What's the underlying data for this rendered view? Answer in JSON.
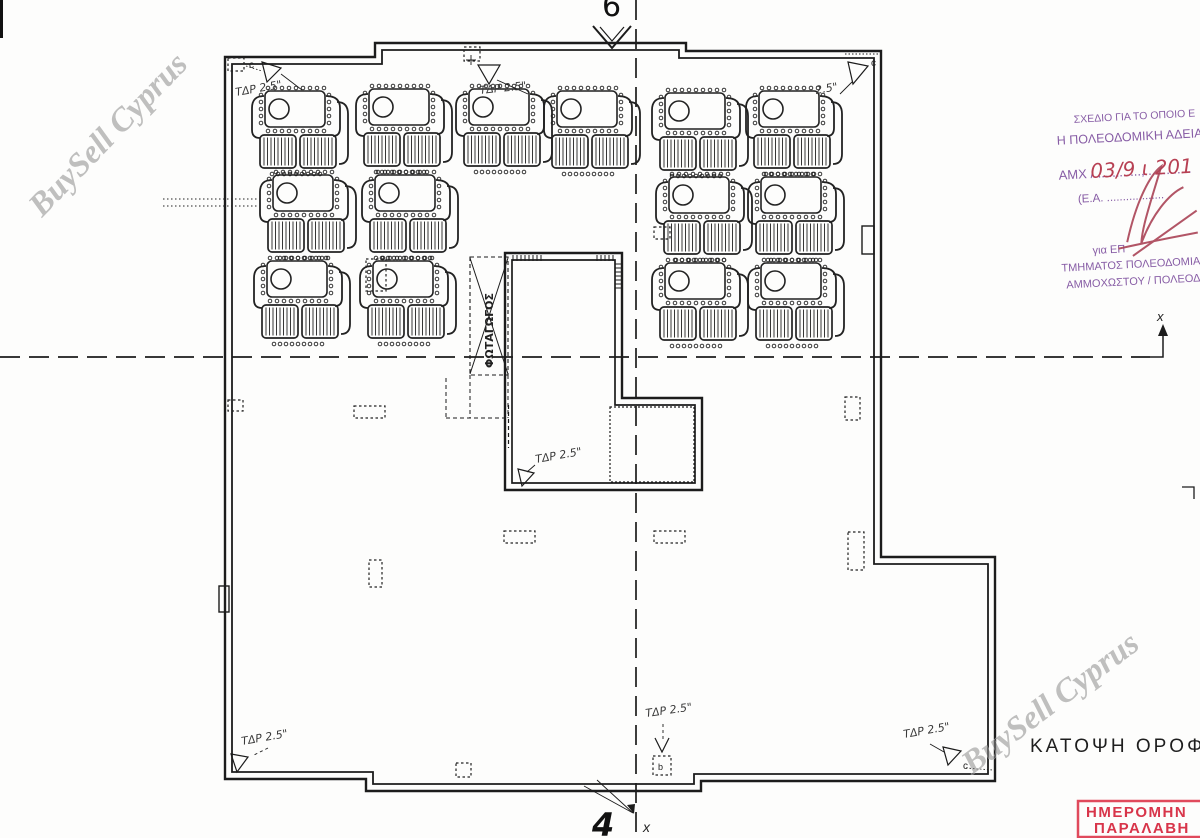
{
  "title": "ΚΑΤΟΨΗ ΟΡΟΦΗΣ",
  "watermark": {
    "text": "BuySell Cyprus",
    "color": "#8d8d8d"
  },
  "stamp_purple": {
    "color": "#7d4f9e",
    "hand_color": "#b23045",
    "lines": {
      "l0": "ΣΧΕΔΙΟ ΓΙΑ ΤΟ ΟΠΟΙΟ Ε",
      "l1": "Η ΠΟΛΕΟΔΟΜΙΚΗ ΑΔΕΙΑ",
      "l2": "ΑΜΧ /.............,.............",
      "l3": "(Ε.Α. ..................",
      "l4": "για ΕΠ",
      "l5": "ΤΜΗΜΑΤΟΣ ΠΟΛΕΟΔΟΜΙΑ",
      "l6": "ΑΜΜΟΧΩΣΤΟΥ / ΠΟΛΕΟΔ"
    },
    "date_hand": "03/9 ι 201"
  },
  "stamp_red": {
    "color": "#d8354a",
    "line1": "ΗΜΕΡΟΜΗΝ",
    "line2": "ΠΑΡΑΛΑΒΗ"
  },
  "lightwell_label": "ΦΩΤΑΓΩΓΟΣ",
  "markers": {
    "section_top": "6",
    "section_bottom": "4",
    "axis_x_right": "x",
    "axis_x_bottom": "x",
    "corner_top_left": "c",
    "corner_top_right": "c",
    "corner_bottom_right": "c",
    "vent_letter": "b",
    "cross": "+"
  },
  "plan": {
    "line_color": "#1c1c1c",
    "units": [
      {
        "x": 248,
        "y": 86
      },
      {
        "x": 352,
        "y": 84
      },
      {
        "x": 452,
        "y": 84
      },
      {
        "x": 540,
        "y": 86
      },
      {
        "x": 648,
        "y": 88
      },
      {
        "x": 742,
        "y": 86
      },
      {
        "x": 256,
        "y": 170
      },
      {
        "x": 358,
        "y": 170
      },
      {
        "x": 652,
        "y": 172
      },
      {
        "x": 744,
        "y": 172
      },
      {
        "x": 250,
        "y": 256
      },
      {
        "x": 356,
        "y": 256
      },
      {
        "x": 648,
        "y": 258
      },
      {
        "x": 744,
        "y": 258
      }
    ],
    "vents": [
      {
        "x": 228,
        "y": 58,
        "w": 16,
        "h": 13
      },
      {
        "x": 464,
        "y": 47,
        "w": 16,
        "h": 14
      },
      {
        "x": 228,
        "y": 400,
        "w": 15,
        "h": 11
      },
      {
        "x": 354,
        "y": 406,
        "w": 31,
        "h": 12
      },
      {
        "x": 369,
        "y": 560,
        "w": 13,
        "h": 27
      },
      {
        "x": 504,
        "y": 531,
        "w": 31,
        "h": 12
      },
      {
        "x": 654,
        "y": 531,
        "w": 31,
        "h": 12
      },
      {
        "x": 845,
        "y": 397,
        "w": 15,
        "h": 23
      },
      {
        "x": 848,
        "y": 532,
        "w": 16,
        "h": 38
      },
      {
        "x": 456,
        "y": 763,
        "w": 15,
        "h": 14
      },
      {
        "x": 653,
        "y": 756,
        "w": 18,
        "h": 19
      },
      {
        "x": 366,
        "y": 259,
        "w": 20,
        "h": 32
      },
      {
        "x": 654,
        "y": 227,
        "w": 16,
        "h": 12
      }
    ],
    "tdp_labels": [
      {
        "text": "ΤΔΡ 2.5\"",
        "x": 236,
        "y": 96,
        "rot": -10
      },
      {
        "text": "ΤΔΡ 2.5\"",
        "x": 480,
        "y": 94,
        "rot": -6
      },
      {
        "text": "2.5\"",
        "x": 816,
        "y": 94,
        "rot": -10
      },
      {
        "text": "ΤΔΡ 2.5\"",
        "x": 536,
        "y": 463,
        "rot": -10
      },
      {
        "text": "ΤΔΡ 2.5\"",
        "x": 646,
        "y": 717,
        "rot": -8
      },
      {
        "text": "ΤΔΡ 2.5\"",
        "x": 904,
        "y": 738,
        "rot": -10
      },
      {
        "text": "ΤΔΡ 2.5\"",
        "x": 242,
        "y": 745,
        "rot": -10
      }
    ]
  }
}
